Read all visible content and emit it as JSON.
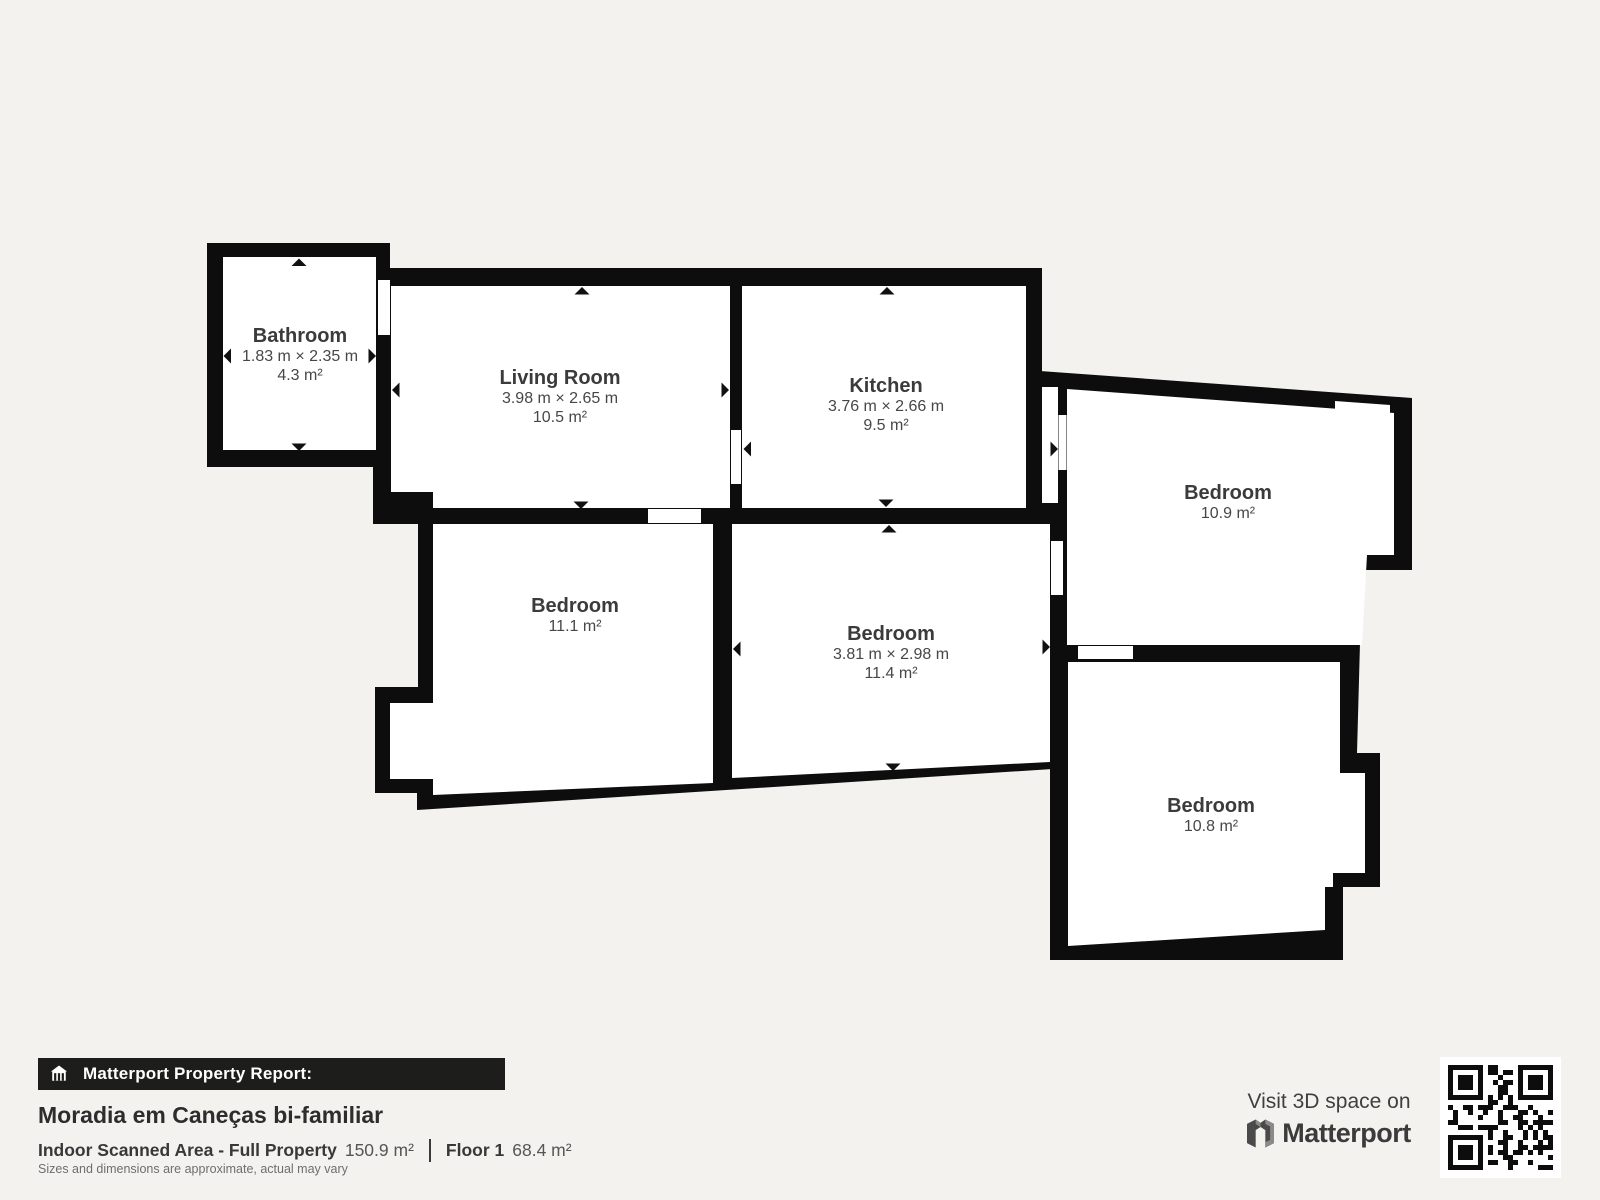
{
  "page": {
    "background_color": "#f4f2ef",
    "wall_color": "#0d0d0d",
    "room_fill_color": "#ffffff"
  },
  "plan": {
    "rooms": [
      {
        "name": "Bathroom",
        "dims": "1.83 m × 2.35 m",
        "area": "4.3 m²"
      },
      {
        "name": "Living Room",
        "dims": "3.98 m × 2.65 m",
        "area": "10.5 m²"
      },
      {
        "name": "Kitchen",
        "dims": "3.76 m × 2.66 m",
        "area": "9.5 m²"
      },
      {
        "name": "Bedroom",
        "dims": "",
        "area": "10.9 m²"
      },
      {
        "name": "Bedroom",
        "dims": "",
        "area": "11.1 m²"
      },
      {
        "name": "Bedroom",
        "dims": "3.81 m × 2.98 m",
        "area": "11.4 m²"
      },
      {
        "name": "Bedroom",
        "dims": "",
        "area": "10.8 m²"
      }
    ]
  },
  "footer": {
    "badge": {
      "icon": "building-icon",
      "label": "Matterport Property Report:"
    },
    "property_title": "Moradia em Caneças bi-familiar",
    "scanned_area_label": "Indoor Scanned Area - Full Property",
    "scanned_area_value": "150.9 m²",
    "floor_label": "Floor 1",
    "floor_value": "68.4 m²",
    "disclaimer": "Sizes and dimensions are approximate, actual may vary",
    "cta": {
      "line": "Visit 3D space on",
      "brand": "Matterport",
      "logo_icon": "matterport-logo-icon",
      "qr_icon": "qr-code"
    }
  }
}
